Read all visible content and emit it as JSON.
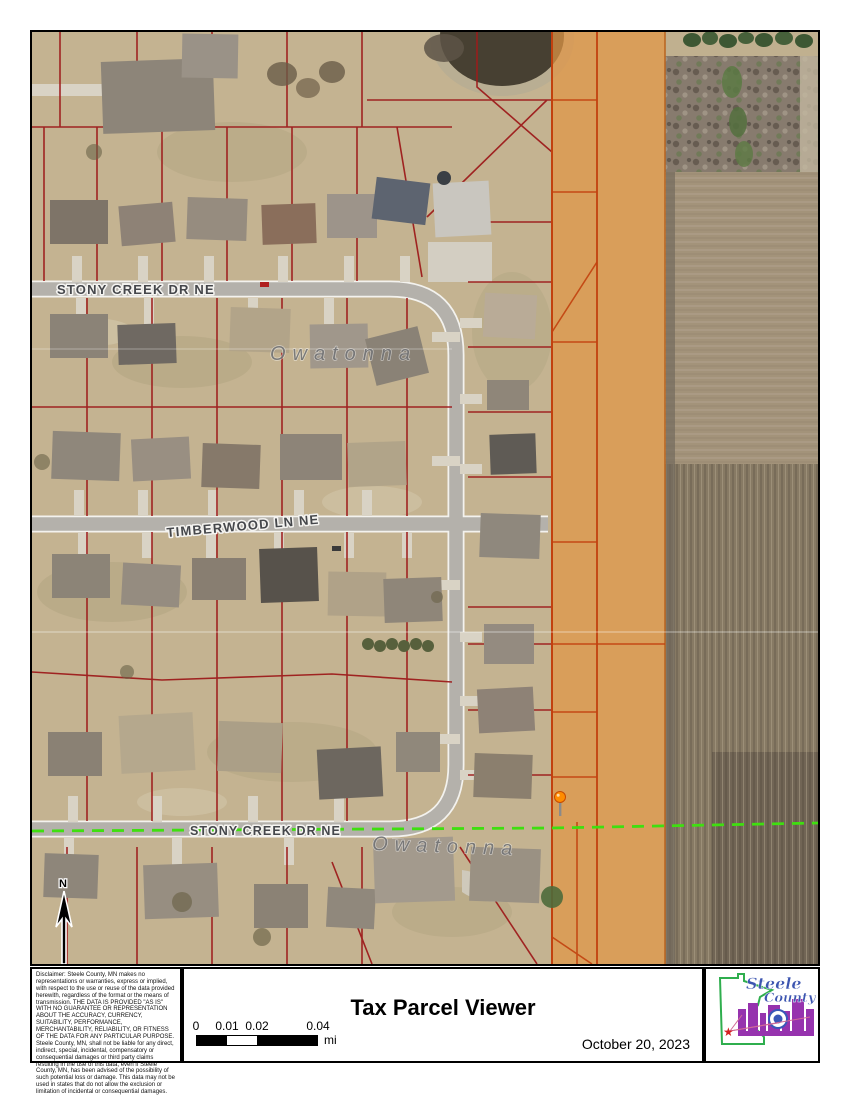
{
  "map": {
    "city_label": "Owatonna",
    "street_top": "STONY CREEK DR NE",
    "street_middle": "TIMBERWOOD LN NE",
    "street_bottom": "STONY CREEK DR NE",
    "north_label": "N"
  },
  "footer": {
    "disclaimer": "Disclaimer:  Steele County, MN makes no representations or warranties, express or implied, with respect to the use or reuse of the data provided herewith, regardless of the format or the means of transmission.  THE DATA IS PROVIDED \"AS IS\" WITH NO GUARANTEE OR REPRESENTATION ABOUT THE ACCURACY, CURRENCY, SUITABILITY, PERFORMANCE, MERCHANTABILITY, RELIABILITY, OR FITNESS OF THE DATA FOR ANY PARTICULAR PURPOSE.  Steele County, MN, shall not be liable for any direct, indirect, special, incidental, compensatory or consequential damages or third party claims resulting in the use of this data, even if Steele County, MN, has been advised of the possibility of such potential loss or damage.  This data may not be used in states that do not allow the exclusion or limitation of incidental or consequential damages.",
    "title": "Tax Parcel Viewer",
    "date": "October 20, 2023",
    "scale": {
      "labels": [
        "0",
        "0.01",
        "0.02",
        "0.04"
      ],
      "unit": "mi"
    }
  },
  "logo": {
    "line1": "Steele",
    "line2": "County"
  },
  "colors": {
    "parcel_line": "#9e1c1c",
    "highlight_parcel": "#e09545",
    "highlight_outline": "#c2410e",
    "boundary_green": "#3fdf10",
    "road_gray": "#b4b1ab",
    "aerial_tan": "#c4b391"
  }
}
